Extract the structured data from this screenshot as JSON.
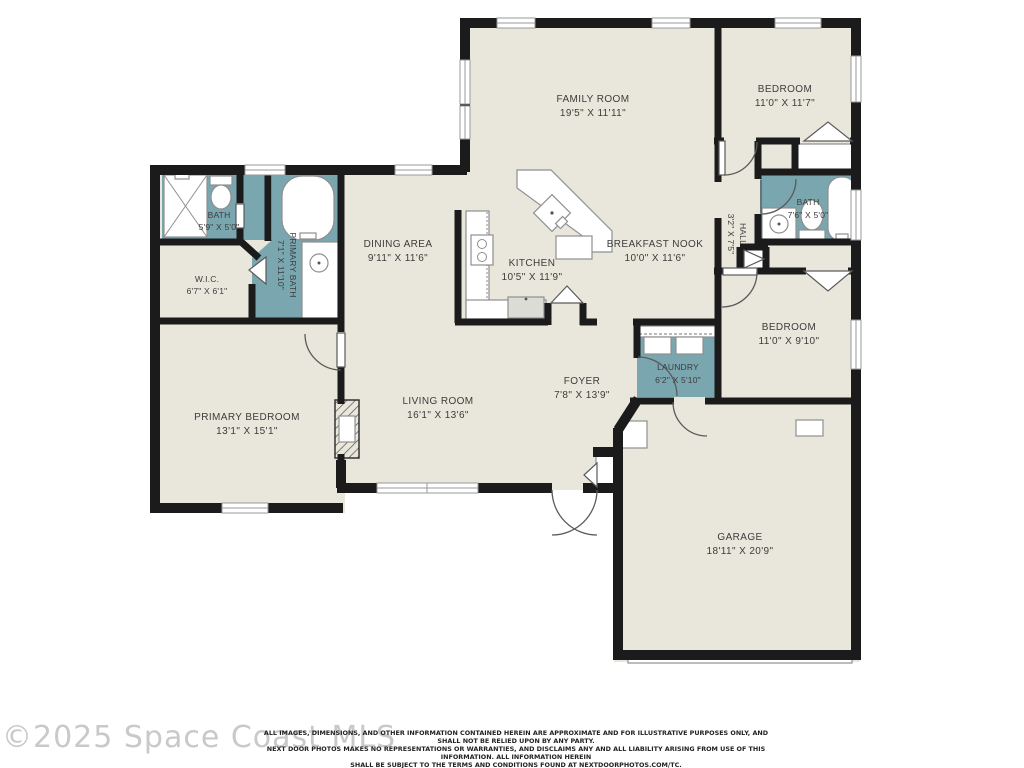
{
  "watermark": "©2025 Space Coast MLS",
  "disclaimer": {
    "line1": "ALL IMAGES, DIMENSIONS, AND OTHER INFORMATION CONTAINED HEREIN ARE APPROXIMATE AND FOR ILLUSTRATIVE PURPOSES ONLY, AND SHALL NOT BE RELIED UPON BY ANY PARTY.",
    "line2": "NEXT DOOR PHOTOS MAKES NO REPRESENTATIONS OR WARRANTIES, AND DISCLAIMS ANY AND ALL LIABILITY ARISING FROM USE OF THIS INFORMATION. ALL INFORMATION HEREIN",
    "line3": "SHALL BE SUBJECT TO THE TERMS AND CONDITIONS FOUND AT NEXTDOORPHOTOS.COM/TC."
  },
  "colors": {
    "floor": "#e9e7db",
    "wet_area": "#7aa6b0",
    "wall": "#1b1b1b",
    "label": "#3c3c3c",
    "watermark": "#c9c9c9",
    "disclaimer": "#222222"
  },
  "rooms": {
    "family": {
      "name": "FAMILY ROOM",
      "dims": "19'5\" X 11'11\""
    },
    "bedroomTR": {
      "name": "BEDROOM",
      "dims": "11'0\" X 11'7\""
    },
    "bathRight": {
      "name": "BATH",
      "dims": "7'6\" X 5'0\""
    },
    "hall": {
      "name": "HALL",
      "dims": "3'2\" X 7'5\""
    },
    "dining": {
      "name": "DINING AREA",
      "dims": "9'11\" X 11'6\""
    },
    "kitchen": {
      "name": "KITCHEN",
      "dims": "10'5\" X 11'9\""
    },
    "nook": {
      "name": "BREAKFAST NOOK",
      "dims": "10'0\" X 11'6\""
    },
    "bathLeft": {
      "name": "BATH",
      "dims": "5'9\" X 5'0\""
    },
    "wic": {
      "name": "W.I.C.",
      "dims": "6'7\" X 6'1\""
    },
    "primaryBath": {
      "name": "PRIMARY BATH",
      "dims": "7'1\" X 11'10\""
    },
    "bedroomRight": {
      "name": "BEDROOM",
      "dims": "11'0\" X 9'10\""
    },
    "laundry": {
      "name": "LAUNDRY",
      "dims": "6'2\" X 5'10\""
    },
    "foyer": {
      "name": "FOYER",
      "dims": "7'8\" X 13'9\""
    },
    "living": {
      "name": "LIVING ROOM",
      "dims": "16'1\" X 13'6\""
    },
    "primaryBedroom": {
      "name": "PRIMARY BEDROOM",
      "dims": "13'1\" X 15'1\""
    },
    "garage": {
      "name": "GARAGE",
      "dims": "18'11\" X 20'9\""
    }
  }
}
